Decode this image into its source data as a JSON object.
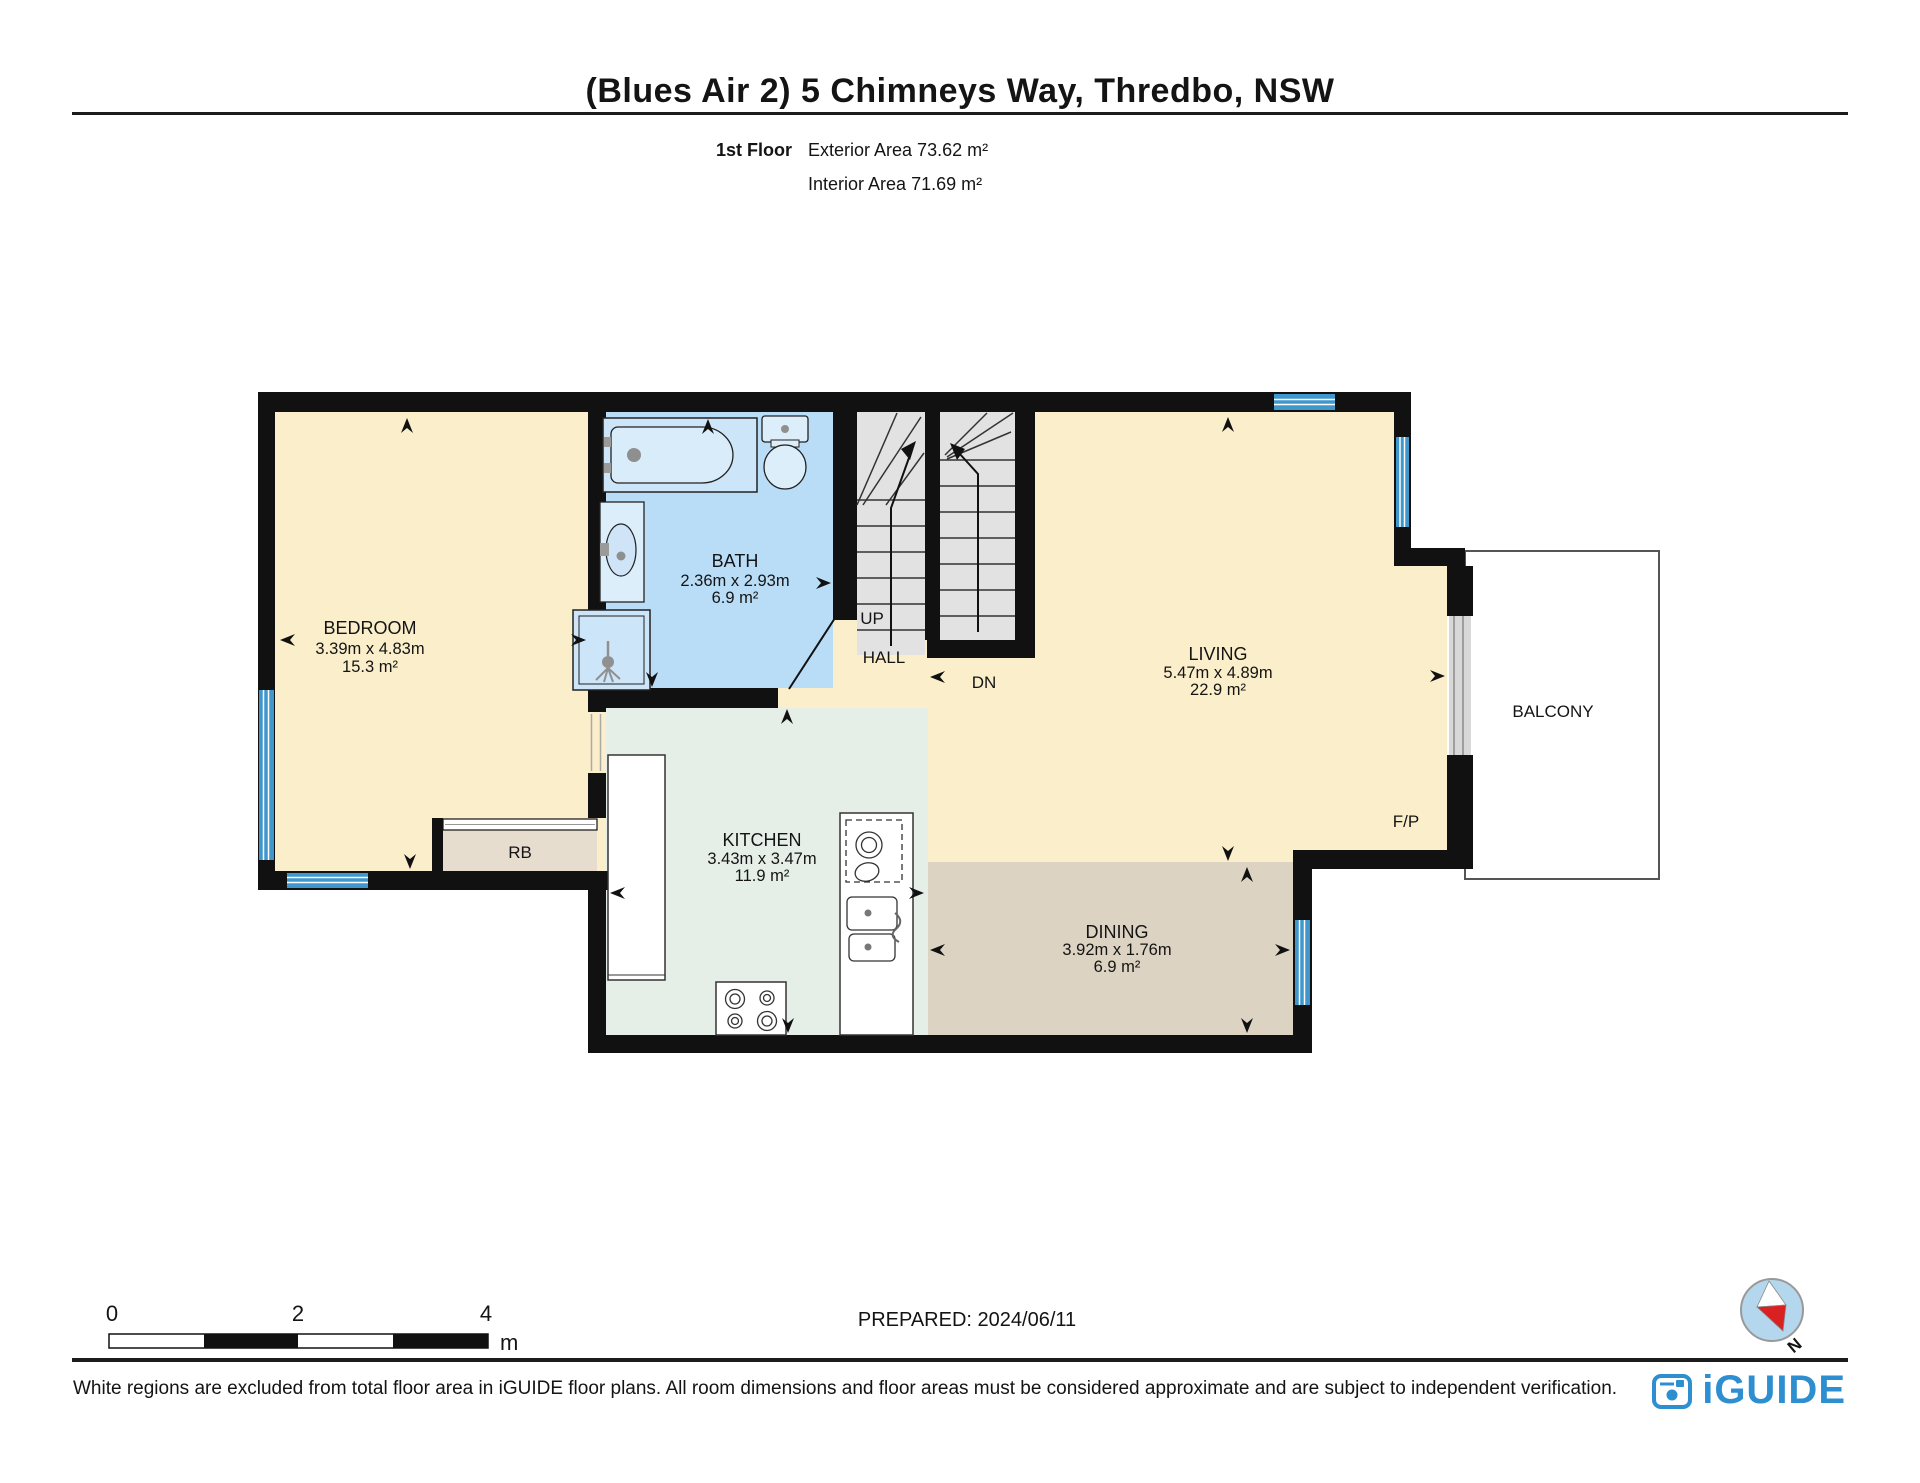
{
  "page": {
    "title": "(Blues Air 2) 5 Chimneys Way, Thredbo, NSW",
    "floor_label": "1st Floor",
    "exterior_area": "Exterior Area 73.62 m²",
    "interior_area": "Interior Area 71.69 m²",
    "prepared": "PREPARED: 2024/06/11",
    "disclaimer": "White regions are excluded from total floor area in iGUIDE floor plans. All room dimensions and floor areas must be considered approximate and are subject to independent verification.",
    "brand": "iGUIDE",
    "compass_north": "N"
  },
  "rooms": {
    "bedroom": {
      "name": "BEDROOM",
      "dims": "3.39m x 4.83m",
      "area": "15.3 m²"
    },
    "bath": {
      "name": "BATH",
      "dims": "2.36m x 2.93m",
      "area": "6.9 m²"
    },
    "living": {
      "name": "LIVING",
      "dims": "5.47m x 4.89m",
      "area": "22.9 m²"
    },
    "kitchen": {
      "name": "KITCHEN",
      "dims": "3.43m x 3.47m",
      "area": "11.9 m²"
    },
    "dining": {
      "name": "DINING",
      "dims": "3.92m x 1.76m",
      "area": "6.9 m²"
    },
    "balcony": {
      "name": "BALCONY"
    },
    "rb": {
      "name": "RB"
    },
    "labels": {
      "up": "UP",
      "hall": "HALL",
      "dn": "DN",
      "fireplace": "F/P"
    }
  },
  "scale_bar": {
    "tick0": "0",
    "tick2": "2",
    "tick4": "4",
    "unit": "m"
  },
  "colors": {
    "room_cream": "#fbeecb",
    "bath_blue": "#b9ddf6",
    "kitchen_mint": "#e6eee8",
    "dining_tan": "#ddd3c2",
    "rb_beige": "#e6ddcf",
    "stair_gray": "#e2e2e2",
    "wall_black": "#111111",
    "window_blue": "#3f97cc",
    "brand_blue": "#2e8fd0",
    "compass_fill": "#b5d7ee",
    "needle_red": "#d92121"
  }
}
